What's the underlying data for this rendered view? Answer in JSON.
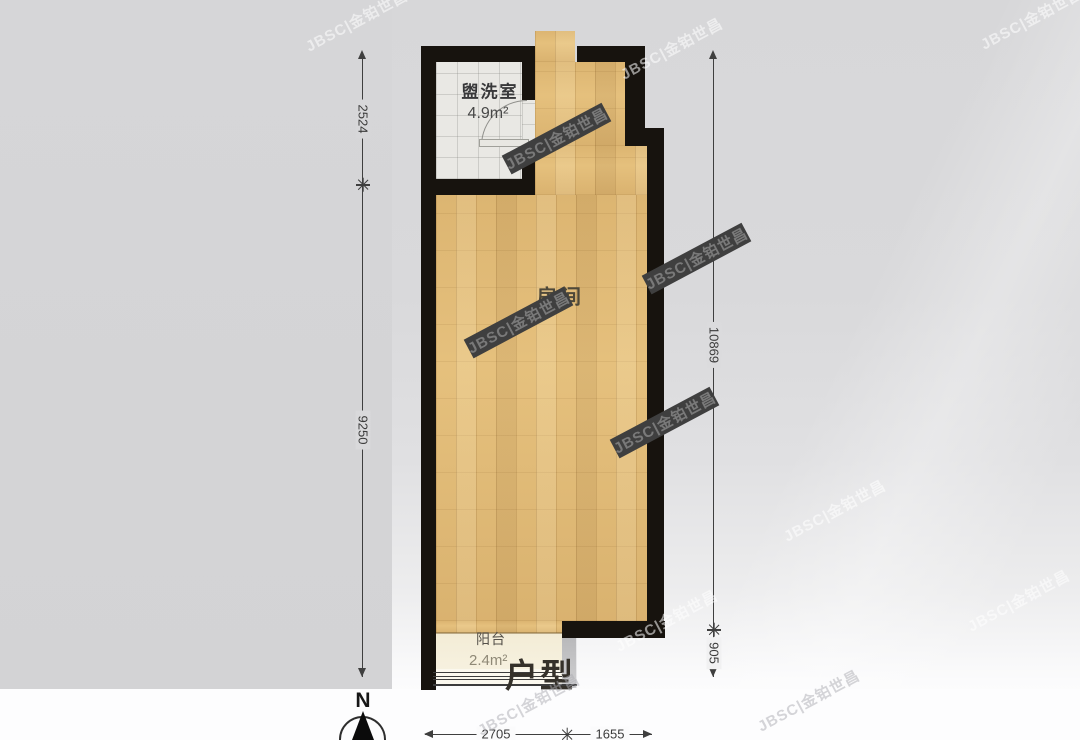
{
  "floorplan": {
    "title": "户型",
    "compass": {
      "north_label": "N"
    },
    "watermark": {
      "text": "JBSC|金铂世昌"
    },
    "rooms": {
      "washroom": {
        "name": "盥洗室",
        "area": "4.9m²"
      },
      "main_room": {
        "name": "房间"
      },
      "balcony": {
        "name": "阳台",
        "area": "2.4m²"
      }
    },
    "dimensions": {
      "left_top": "2524",
      "left_bottom": "9250",
      "right_top": "10869",
      "right_bottom": "905",
      "bottom_left": "2705",
      "bottom_right": "1655"
    },
    "colors": {
      "wall": "#17130e",
      "wood_floor": "#e3bd79",
      "tile_floor": "#e9e8e4",
      "balcony_floor": "#f3ecd6",
      "dimension": "#3f3f3f"
    }
  }
}
